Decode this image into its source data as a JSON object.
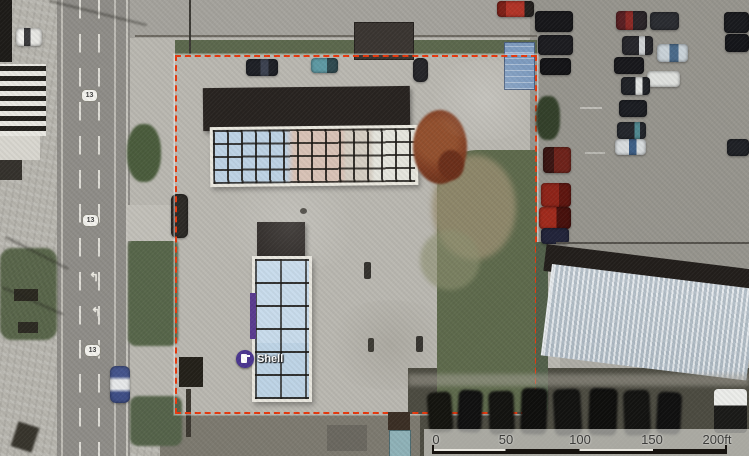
{
  "map": {
    "type": "aerial-photo-with-parcel-overlay",
    "poi": {
      "label": "Shell",
      "kind": "gas-station",
      "marker_color": "#4a3590"
    },
    "route_shield": {
      "label": "13"
    },
    "road_arrow": {
      "glyph": "↰"
    },
    "parcel_boundary": {
      "style": "dashed",
      "color": "#e8380d"
    },
    "scale_bar": {
      "labels": [
        "0",
        "50",
        "100",
        "150",
        "200ft"
      ],
      "unit": "ft",
      "length_ft": 200
    }
  },
  "colors": {
    "asphalt": "#8f8d88",
    "concrete": "#b7b5ae",
    "grass": "#5b684c",
    "roof_dark": "#282320",
    "canopy_glass_blue": "#bed3e5",
    "canopy_glass_pink": "#d9c3b7",
    "metal_roof": "#c7d0d8",
    "boundary_red": "#e8380d",
    "shell_purple": "#4a3590",
    "rust_tree": "#7e3c22"
  }
}
